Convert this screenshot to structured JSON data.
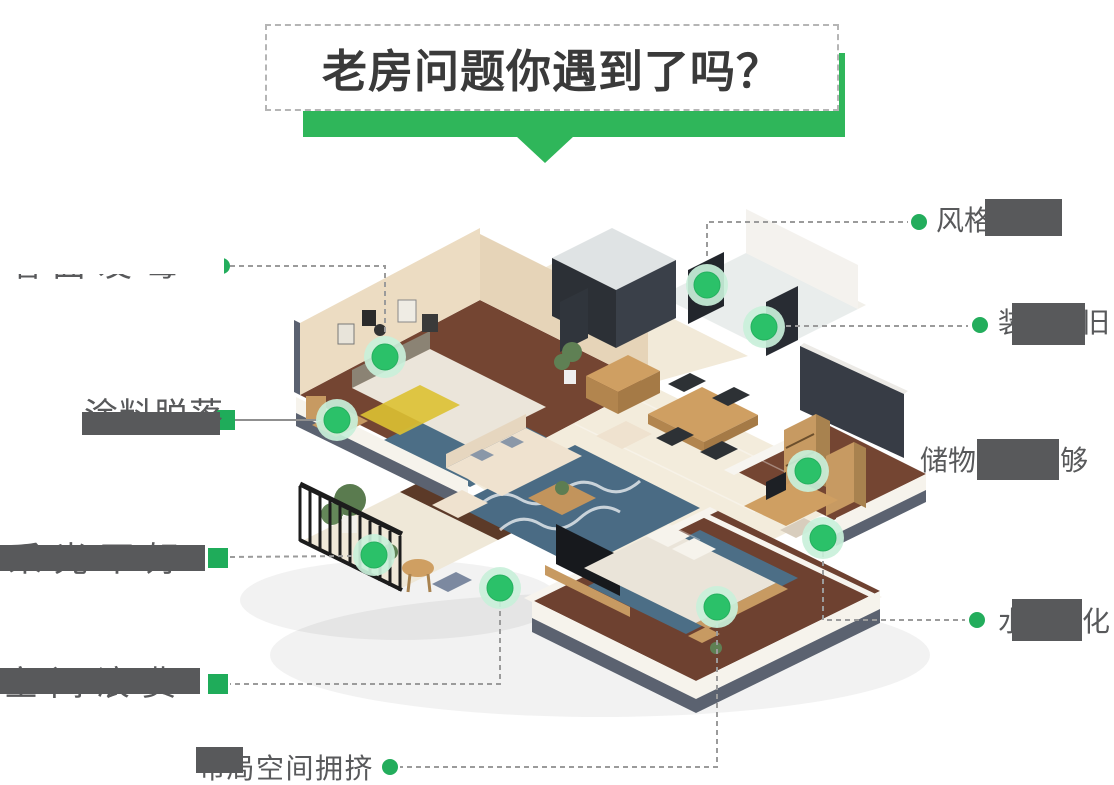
{
  "title": {
    "text": "老房问题你遇到了吗？"
  },
  "illustration_alt": "3D isometric cutaway floor plan of an old apartment with green problem hotspots",
  "callouts": [
    {
      "id": "wall-mold",
      "label": "墙面发霉"
    },
    {
      "id": "paint-peeling",
      "label": "涂料脱落"
    },
    {
      "id": "style-outdated",
      "label": "风格老旧"
    },
    {
      "id": "reno-outdated",
      "label": "装修老旧"
    },
    {
      "id": "storage-short",
      "label": "储物空间不够"
    },
    {
      "id": "pipes-aging",
      "label": "水电老化"
    },
    {
      "id": "poor-lighting",
      "label": "采光不好"
    },
    {
      "id": "wasted-space",
      "label": "空间浪费"
    },
    {
      "id": "crowded-layout",
      "label": "布局空间拥挤"
    }
  ],
  "colors": {
    "accent_green": "#2fb65a",
    "marker_green": "#2bc169",
    "marker_halo": "#c9f0da",
    "connector_dot_green": "#23ad5c",
    "connector_line_gray": "#9b9b9b",
    "label_gray": "#58595b",
    "title_text": "#3a3a3a"
  }
}
